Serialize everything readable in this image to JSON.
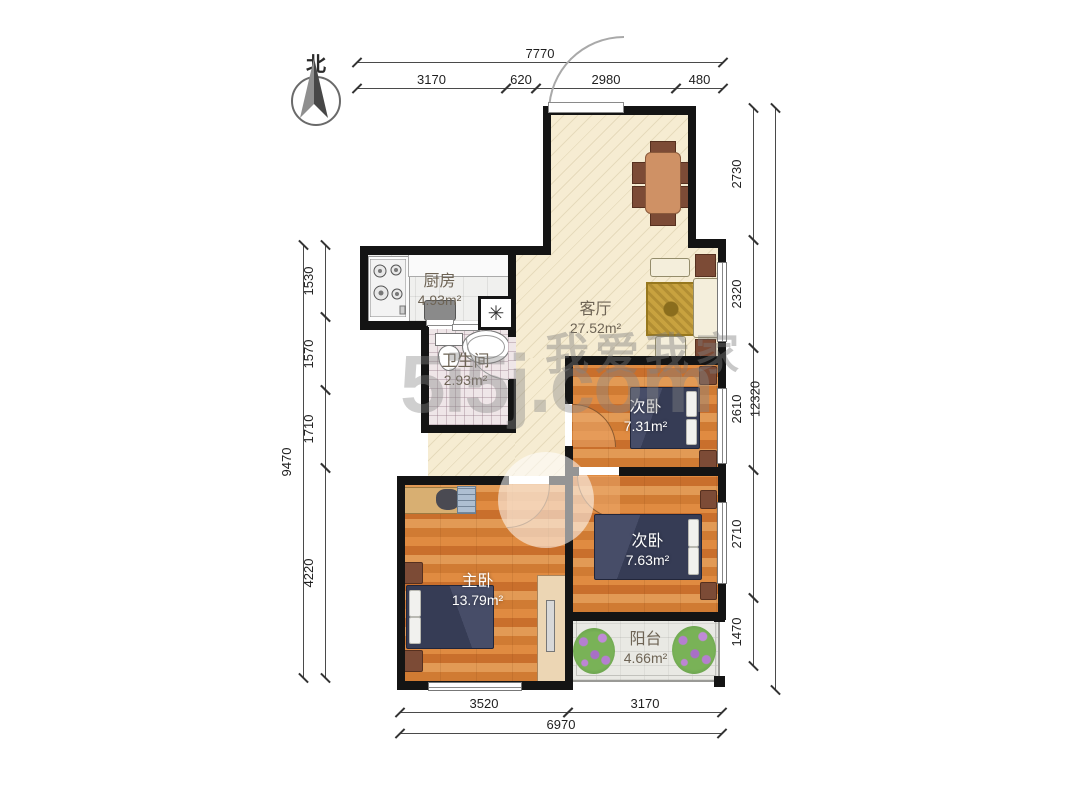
{
  "compass": {
    "label": "北"
  },
  "watermark": {
    "line1": "我爱我家",
    "line2": "5i5j.com"
  },
  "rooms": {
    "kitchen": {
      "name": "厨房",
      "area": "4.93m²"
    },
    "bathroom": {
      "name": "卫生间",
      "area": "2.93m²"
    },
    "living": {
      "name": "客厅",
      "area": "27.52m²"
    },
    "bedroom2a": {
      "name": "次卧",
      "area": "7.31m²"
    },
    "bedroom2b": {
      "name": "次卧",
      "area": "7.63m²"
    },
    "master": {
      "name": "主卧",
      "area": "13.79m²"
    },
    "balcony": {
      "name": "阳台",
      "area": "4.66m²"
    }
  },
  "shaft": {
    "symbol": "✳"
  },
  "dimensions": {
    "top": {
      "total": "7770",
      "segments": [
        "3170",
        "620",
        "2980",
        "480"
      ]
    },
    "left": {
      "total": "9470",
      "segments": [
        "1530",
        "1570",
        "1710",
        "4220"
      ]
    },
    "right": {
      "total": "12320",
      "segments": [
        "2730",
        "2320",
        "2610",
        "2710",
        "1470"
      ]
    },
    "bottom": {
      "total": "6970",
      "segments": [
        "3520",
        "3170"
      ]
    }
  }
}
